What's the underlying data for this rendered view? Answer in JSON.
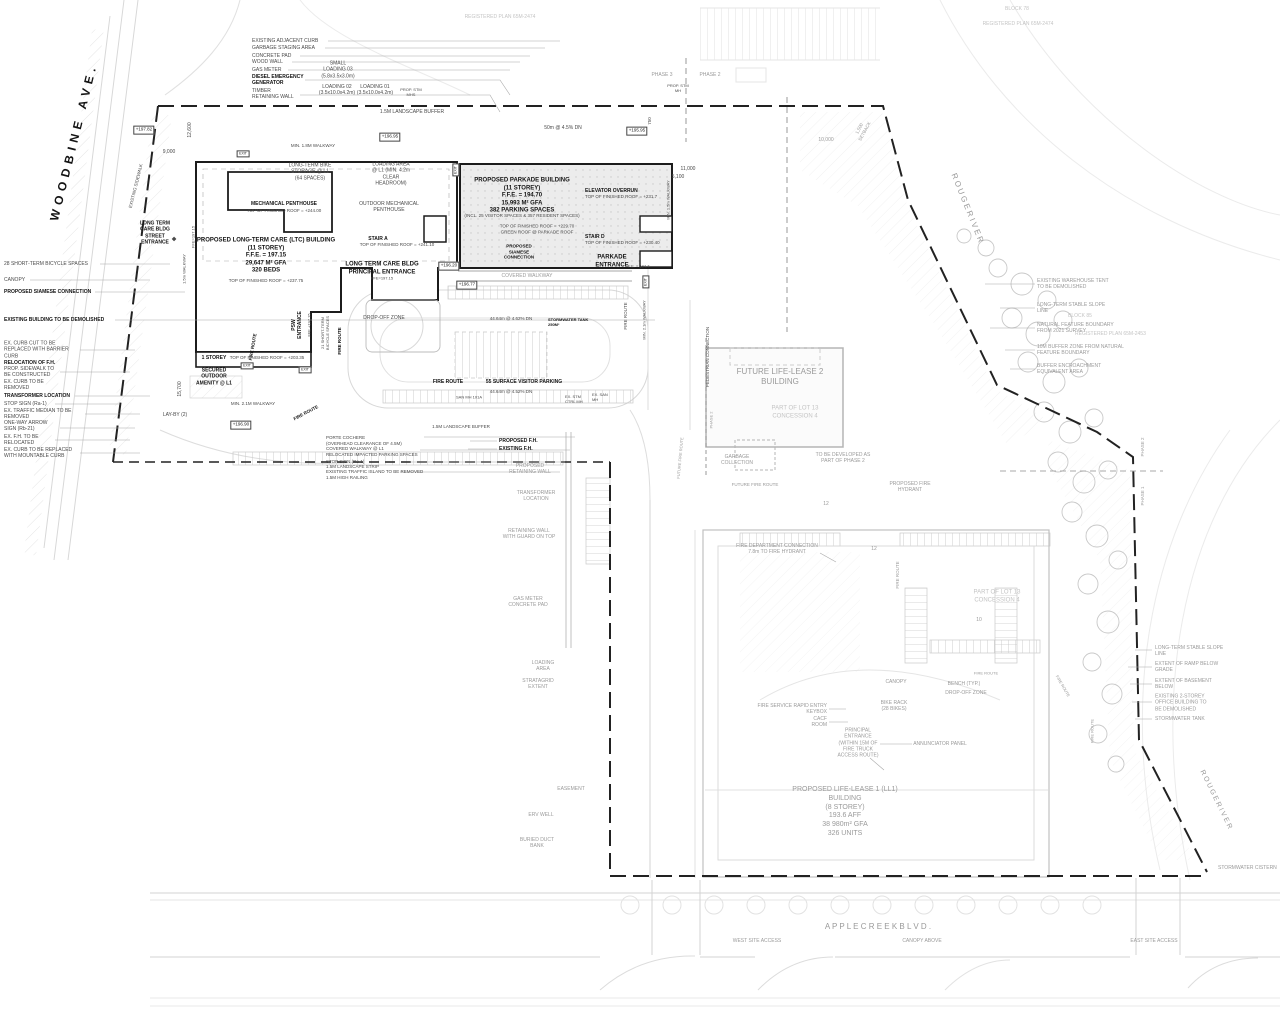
{
  "colors": {
    "building_outline": "#1c1c1c",
    "parkade_fill": "#ececec",
    "boundary": "#222222",
    "faint_line": "#d8d8d8",
    "gray_text": "#9a9a9a"
  },
  "labels": [
    {
      "n": "street-name-woodbine",
      "t": "WOODBINE AVE.",
      "x": 74,
      "y": 142,
      "r": -76,
      "s": 12,
      "ls": 5,
      "c": "b"
    },
    {
      "n": "street-name-apple-creek",
      "t": "A P P L E   C R E E K   B L V D .",
      "x": 878,
      "y": 927,
      "c": "g",
      "s": 8
    },
    {
      "n": "rouge-river-label",
      "t": "R O U G E   R I V E R",
      "x": 967,
      "y": 208,
      "r": 68,
      "c": "g",
      "s": 8
    },
    {
      "n": "rouge-river-label",
      "t": "R O U G E   R I V E R",
      "x": 1215,
      "y": 800,
      "r": 64,
      "c": "g",
      "s": 7
    },
    {
      "t": "WEST SITE ACCESS",
      "x": 757,
      "y": 941,
      "c": "g",
      "s": 5
    },
    {
      "t": "CANOPY ABOVE",
      "x": 922,
      "y": 941,
      "c": "g",
      "s": 5
    },
    {
      "t": "EAST SITE ACCESS",
      "x": 1154,
      "y": 941,
      "c": "g",
      "s": 5
    },
    {
      "t": "REGISTERED PLAN 65M-2474",
      "x": 500,
      "y": 17,
      "c": "f"
    },
    {
      "t": "BLOCK 78",
      "x": 1017,
      "y": 9,
      "c": "f"
    },
    {
      "t": "REGISTERED PLAN 65M-2474",
      "x": 1018,
      "y": 24,
      "c": "f"
    },
    {
      "t": "PHASE 3",
      "x": 662,
      "y": 75,
      "c": "g"
    },
    {
      "t": "PHASE 2",
      "x": 710,
      "y": 75,
      "c": "g"
    },
    {
      "t": "PROP. STM\nMH",
      "x": 678,
      "y": 88,
      "s": 4
    },
    {
      "t": "EXISTING ADJACENT CURB",
      "a": "l",
      "x": 252,
      "y": 41
    },
    {
      "t": "GARBAGE STAGING AREA",
      "a": "l",
      "x": 252,
      "y": 48
    },
    {
      "t": "CONCRETE PAD",
      "a": "l",
      "x": 252,
      "y": 56
    },
    {
      "t": "WOOD WALL",
      "a": "l",
      "x": 252,
      "y": 62
    },
    {
      "t": "GAS METER",
      "a": "l",
      "x": 252,
      "y": 70
    },
    {
      "t": "DIESEL EMERGENCY\nGENERATOR",
      "b": 1,
      "a": "l",
      "x": 252,
      "y": 80
    },
    {
      "t": "TIMBER\nRETAINING WALL",
      "a": "l",
      "x": 252,
      "y": 94
    },
    {
      "t": "SMALL\nLOADING 03\n(5.8x3.5x3.0m)",
      "x": 338,
      "y": 70
    },
    {
      "t": "LOADING 02\n(3.5x10.0x4.2m)",
      "x": 337,
      "y": 90
    },
    {
      "t": "LOADING 01\n(3.5x10.0x4.2m)",
      "x": 375,
      "y": 90
    },
    {
      "t": "PROP. STM\nMHS",
      "x": 411,
      "y": 92,
      "s": 4
    },
    {
      "t": "1.5M LANDSCAPE BUFFER",
      "x": 412,
      "y": 112
    },
    {
      "t": "50m @ 4.5% DN",
      "x": 563,
      "y": 128
    },
    {
      "t": "+195.95",
      "x": 637,
      "y": 131,
      "c": "bx"
    },
    {
      "t": "+196.95",
      "x": 390,
      "y": 137,
      "c": "bx"
    },
    {
      "t": "+197.82",
      "x": 144,
      "y": 130,
      "c": "bx"
    },
    {
      "t": "12,600",
      "x": 190,
      "y": 130,
      "r": -90
    },
    {
      "t": "9,000",
      "x": 169,
      "y": 152
    },
    {
      "t": "MIN. 1.8M WALKWAY",
      "x": 313,
      "y": 146,
      "s": 4.5
    },
    {
      "t": "EXISTING SIDEWALK",
      "x": 136,
      "y": 186,
      "r": -76,
      "s": 4.5
    },
    {
      "t": "15,700",
      "x": 180,
      "y": 389,
      "r": -90
    },
    {
      "t": "LONG TERM\nCARE BLDG\nSTREET\nENTRANCE",
      "b": 1,
      "x": 155,
      "y": 233
    },
    {
      "t": "◆",
      "x": 174,
      "y": 240,
      "s": 6
    },
    {
      "t": "FFE=197.15",
      "x": 193,
      "y": 237,
      "r": -90,
      "s": 4
    },
    {
      "t": "1.5m WALKWAY",
      "x": 184,
      "y": 269,
      "r": -90,
      "s": 4
    },
    {
      "t": "LONG-TERM BIKE\nSTORAGE @ L1\n(64 SPACES)",
      "x": 310,
      "y": 172
    },
    {
      "t": "LOADING AREA\n@ L1 (MIN. 4.2m\nCLEAR\nHEADROOM)",
      "x": 391,
      "y": 174
    },
    {
      "t": "MECHANICAL PENTHOUSE",
      "b": 1,
      "x": 284,
      "y": 204
    },
    {
      "t": "TOP OF FINISHED ROOF = +244.00",
      "x": 284,
      "y": 211,
      "s": 4.5
    },
    {
      "t": "OUTDOOR MECHANICAL\nPENTHOUSE",
      "x": 389,
      "y": 207
    },
    {
      "n": "ltc-building-title",
      "t": "PROPOSED LONG-TERM CARE (LTC) BUILDING\n(11 STOREY)\nF.F.E. = 197.15\n29,647 M² GFA\n320 BEDS",
      "b": 1,
      "x": 266,
      "y": 256,
      "s": 6
    },
    {
      "t": "TOP OF FINISHED ROOF = +237.75",
      "x": 266,
      "y": 281,
      "s": 4.5
    },
    {
      "t": "STAIR A",
      "b": 1,
      "x": 378,
      "y": 239
    },
    {
      "t": "TOP OF FINISHED ROOF = +241.10",
      "x": 397,
      "y": 245,
      "s": 4.5
    },
    {
      "t": "LONG TERM CARE BLDG\nPRINCIPAL ENTRANCE",
      "b": 1,
      "x": 382,
      "y": 269,
      "s": 6
    },
    {
      "t": "FFE=197.15",
      "x": 382,
      "y": 278,
      "s": 4
    },
    {
      "t": "+196.20",
      "x": 449,
      "y": 266,
      "c": "bx"
    },
    {
      "t": "+196.77",
      "x": 467,
      "y": 285,
      "c": "bx"
    },
    {
      "t": "DROP-OFF ZONE",
      "x": 384,
      "y": 318
    },
    {
      "t": "PSW\nENTRANCE",
      "b": 1,
      "x": 297,
      "y": 325,
      "r": -90
    },
    {
      "t": "FFE +197.15",
      "x": 309,
      "y": 325,
      "r": -90,
      "s": 4
    },
    {
      "t": "21 SHORT-TERM\nBICYCLE SPACES",
      "x": 325,
      "y": 333,
      "r": -90,
      "s": 4
    },
    {
      "t": "FIRE ROUTE",
      "b": 1,
      "x": 340,
      "y": 341,
      "r": -90,
      "s": 4.5
    },
    {
      "t": "1 STOREY",
      "b": 1,
      "x": 214,
      "y": 358
    },
    {
      "t": "TOP OF FINISHED ROOF = +203.35",
      "x": 267,
      "y": 358,
      "s": 4.5
    },
    {
      "t": "SECURED\nOUTDOOR\nAMENITY @ L1",
      "b": 1,
      "x": 214,
      "y": 377
    },
    {
      "t": "MIN. 2.1M WALKWAY",
      "x": 253,
      "y": 404,
      "s": 4.5
    },
    {
      "t": "LAY-BY (2)",
      "x": 175,
      "y": 415
    },
    {
      "t": "+196.90",
      "x": 241,
      "y": 425,
      "c": "bx"
    },
    {
      "t": "EXIT",
      "x": 243,
      "y": 154,
      "s": 3.5,
      "c": "bx"
    },
    {
      "t": "EXIT",
      "x": 247,
      "y": 366,
      "s": 3.5,
      "c": "bx"
    },
    {
      "t": "EXIT",
      "x": 305,
      "y": 370,
      "s": 3.5,
      "c": "bx"
    },
    {
      "t": "EXIT",
      "x": 456,
      "y": 170,
      "r": -90,
      "s": 3.5,
      "c": "bx"
    },
    {
      "t": "EXIT",
      "x": 646,
      "y": 282,
      "r": -90,
      "s": 3.5,
      "c": "bx"
    },
    {
      "n": "parkade-building-title",
      "t": "PROPOSED PARKADE BUILDING\n(11 STOREY)\nF.F.E. = 194.70\n15,993 M² GFA\n382 PARKING SPACES",
      "b": 1,
      "x": 522,
      "y": 196,
      "s": 6
    },
    {
      "t": "(INCL. 25 VISITOR SPACES & 357 RESIDENT SPACES)",
      "x": 522,
      "y": 216,
      "s": 4.5
    },
    {
      "t": "TOP OF FINISHED ROOF = +229.70\nGREEN ROOF @ PARKADE ROOF",
      "x": 537,
      "y": 229,
      "s": 4.5
    },
    {
      "t": "ELEVATOR OVERRUN",
      "b": 1,
      "a": "l",
      "x": 585,
      "y": 191
    },
    {
      "t": "TOP OF FINISHED ROOF = +231.7",
      "a": "l",
      "x": 585,
      "y": 197,
      "s": 4.5
    },
    {
      "t": "STAIR D",
      "b": 1,
      "a": "l",
      "x": 585,
      "y": 237
    },
    {
      "t": "TOP OF FINISHED ROOF = +230.40",
      "a": "l",
      "x": 585,
      "y": 243,
      "s": 4.5
    },
    {
      "t": "PROPOSED\nSIAMESE\nCONNECTION",
      "b": 1,
      "x": 519,
      "y": 252,
      "s": 4.5
    },
    {
      "t": "PARKADE\nENTRANCE",
      "b": 1,
      "x": 612,
      "y": 262,
      "s": 6
    },
    {
      "t": "F.E. = 194.7",
      "a": "l",
      "x": 628,
      "y": 266,
      "s": 4
    },
    {
      "t": "COVERED WALKWAY",
      "x": 527,
      "y": 276,
      "c": "g"
    },
    {
      "t": "MIN. 1.5m WALKWAY",
      "x": 668,
      "y": 200,
      "r": -90,
      "s": 4
    },
    {
      "t": "750",
      "x": 650,
      "y": 121,
      "r": -90,
      "s": 4.5
    },
    {
      "t": "11,000",
      "x": 688,
      "y": 169
    },
    {
      "t": "5,100",
      "x": 678,
      "y": 177
    },
    {
      "t": "10,000",
      "x": 826,
      "y": 140,
      "c": "g"
    },
    {
      "t": "1,500\nSETBACK",
      "x": 862,
      "y": 130,
      "r": -62,
      "c": "g",
      "s": 4.5
    },
    {
      "t": "44.64m @ 4.62% DN",
      "x": 511,
      "y": 319,
      "s": 4.5
    },
    {
      "t": "STORMWATER TANK\n250M³",
      "b": 1,
      "a": "l",
      "x": 548,
      "y": 322,
      "s": 4
    },
    {
      "t": "FIRE ROUTE",
      "b": 1,
      "x": 448,
      "y": 382,
      "s": 5
    },
    {
      "t": "55 SURFACE VISITOR PARKING",
      "b": 1,
      "x": 524,
      "y": 382,
      "s": 5
    },
    {
      "t": "44.64m @ 4.52% DN",
      "x": 511,
      "y": 392,
      "s": 4.5
    },
    {
      "t": "SAN MH 101A",
      "x": 469,
      "y": 397,
      "s": 4
    },
    {
      "t": "EX. STM\nCTRL MH",
      "a": "l",
      "x": 565,
      "y": 399,
      "s": 4
    },
    {
      "t": "EX. SAN\nMH",
      "a": "l",
      "x": 592,
      "y": 397,
      "s": 4
    },
    {
      "t": "FIRE ROUTE",
      "x": 626,
      "y": 316,
      "r": -90,
      "s": 4.5
    },
    {
      "t": "MIN. 2.1m WALKWAY",
      "x": 644,
      "y": 320,
      "r": -90,
      "s": 4
    },
    {
      "t": "PEDESTRIAN CONNECTION",
      "x": 708,
      "y": 357,
      "r": -90,
      "s": 4.5
    },
    {
      "t": "PHASE 2",
      "x": 711,
      "y": 420,
      "r": -90,
      "c": "g",
      "s": 4
    },
    {
      "t": "FIRE ROUTE",
      "b": 1,
      "x": 253,
      "y": 347,
      "r": -80,
      "s": 4.5
    },
    {
      "t": "FIRE ROUTE",
      "b": 1,
      "x": 306,
      "y": 413,
      "r": -28,
      "s": 4.5
    },
    {
      "t": "PORTE COCHERE\n(OVERHEAD CLEARANCE OF 4.5M)\nCOVERED WALKWAY @ L1\nRELOCATED IMPACTED PARKING SPACES",
      "a": "l",
      "x": 326,
      "y": 446,
      "s": 4.5
    },
    {
      "t": "STOP SIGN (Ra-1)",
      "a": "l",
      "x": 326,
      "y": 462,
      "s": 4.5
    },
    {
      "t": "1.5M LANDSCAPE STRIP",
      "a": "l",
      "x": 326,
      "y": 467,
      "s": 4.5
    },
    {
      "t": "EXISTING TRAFFIC ISLAND TO BE REMOVED",
      "a": "l",
      "x": 326,
      "y": 472,
      "s": 4.5
    },
    {
      "t": "1.5M HIGH RAILING",
      "a": "l",
      "x": 326,
      "y": 478,
      "s": 4.5
    },
    {
      "t": "1.5M LANDSCAPE BUFFER",
      "x": 461,
      "y": 427,
      "s": 4.5
    },
    {
      "t": "PROPOSED F.H.",
      "b": 1,
      "a": "l",
      "x": 499,
      "y": 441
    },
    {
      "t": "EXISTING F.H.",
      "b": 1,
      "a": "l",
      "x": 499,
      "y": 449
    },
    {
      "t": "PROPOSED\nRETAINING WALL",
      "x": 530,
      "y": 469,
      "c": "g"
    },
    {
      "t": "TRANSFORMER\nLOCATION",
      "x": 536,
      "y": 496,
      "c": "g"
    },
    {
      "t": "RETAINING WALL\nWITH GUARD ON TOP",
      "x": 529,
      "y": 534,
      "c": "g"
    },
    {
      "t": "GAS METER\nCONCRETE PAD",
      "x": 528,
      "y": 602,
      "c": "g"
    },
    {
      "t": "28 SHORT-TERM BICYCLE SPACES",
      "a": "l",
      "x": 4,
      "y": 264
    },
    {
      "t": "CANOPY",
      "a": "l",
      "x": 4,
      "y": 280
    },
    {
      "t": "PROPOSED SIAMESE CONNECTION",
      "b": 1,
      "a": "l",
      "x": 4,
      "y": 292
    },
    {
      "t": "EXISTING BUILDING TO BE DEMOLISHED",
      "b": 1,
      "a": "l",
      "x": 4,
      "y": 320
    },
    {
      "t": "EX. CURB CUT TO BE\nREPLACED WITH BARRIER\nCURB",
      "a": "l",
      "x": 4,
      "y": 350
    },
    {
      "t": "RELOCATION OF F.H.",
      "b": 1,
      "a": "l",
      "x": 4,
      "y": 363
    },
    {
      "t": "PROP. SIDEWALK TO\nBE CONSTRUCTED",
      "a": "l",
      "x": 4,
      "y": 372
    },
    {
      "t": "EX. CURB TO BE\nREMOVED",
      "a": "l",
      "x": 4,
      "y": 385
    },
    {
      "t": "TRANSFORMER LOCATION",
      "b": 1,
      "a": "l",
      "x": 4,
      "y": 396
    },
    {
      "t": "STOP SIGN (Ra-1)",
      "a": "l",
      "x": 4,
      "y": 404
    },
    {
      "t": "EX. TRAFFIC MEDIAN TO BE\nREMOVED",
      "a": "l",
      "x": 4,
      "y": 414
    },
    {
      "t": "ONE-WAY ARROW\nSIGN (Rb-21)",
      "a": "l",
      "x": 4,
      "y": 426
    },
    {
      "t": "EX. F.H. TO BE\nRELOCATED",
      "a": "l",
      "x": 4,
      "y": 440
    },
    {
      "t": "EX. CURB TO BE REPLACED\nWITH MOUNTABLE CURB",
      "a": "l",
      "x": 4,
      "y": 453
    },
    {
      "n": "ll2-building-title",
      "t": "FUTURE LIFE-LEASE 2\nBUILDING",
      "x": 780,
      "y": 377,
      "c": "g",
      "s": 8
    },
    {
      "t": "PART OF LOT 13\nCONCESSION 4",
      "x": 795,
      "y": 413,
      "c": "f",
      "s": 6
    },
    {
      "t": "GARBAGE\nCOLLECTION",
      "x": 737,
      "y": 460,
      "c": "g"
    },
    {
      "t": "TO BE DEVELOPED AS\nPART OF PHASE 2",
      "x": 843,
      "y": 458,
      "c": "g"
    },
    {
      "t": "FUTURE FIRE ROUTE",
      "x": 755,
      "y": 485,
      "c": "g",
      "s": 4.5
    },
    {
      "t": "FUTURE FIRE ROUTE",
      "x": 680,
      "y": 458,
      "r": -85,
      "c": "g",
      "s": 4
    },
    {
      "t": "PROPOSED FIRE\nHYDRANT",
      "x": 910,
      "y": 487,
      "c": "g"
    },
    {
      "t": "12",
      "x": 826,
      "y": 504,
      "c": "g"
    },
    {
      "t": "EXISTING WAREHOUSE TENT\nTO BE DEMOLISHED",
      "a": "l",
      "x": 1037,
      "y": 284,
      "c": "g"
    },
    {
      "t": "LONG-TERM STABLE SLOPE\nLINE",
      "a": "l",
      "x": 1037,
      "y": 308,
      "c": "g"
    },
    {
      "t": "BLOCK 85",
      "a": "l",
      "x": 1068,
      "y": 316,
      "c": "f"
    },
    {
      "t": "NATURAL FEATURE BOUNDARY\nFROM 2021 SURVEY",
      "a": "l",
      "x": 1037,
      "y": 328,
      "c": "g"
    },
    {
      "t": "REGISTERED PLAN 65M-2453",
      "a": "l",
      "x": 1075,
      "y": 334,
      "c": "f"
    },
    {
      "t": "10M BUFFER ZONE FROM NATURAL\nFEATURE BOUNDARY",
      "a": "l",
      "x": 1037,
      "y": 350,
      "c": "g"
    },
    {
      "t": "BUFFER ENCROACHMENT\nEQUIVALENT AREA",
      "a": "l",
      "x": 1037,
      "y": 369,
      "c": "g"
    },
    {
      "t": "PHASE 2",
      "x": 1143,
      "y": 447,
      "r": -90,
      "c": "g",
      "s": 4.5
    },
    {
      "t": "PHASE 1",
      "x": 1143,
      "y": 496,
      "r": -90,
      "c": "g",
      "s": 4.5
    },
    {
      "t": "LOADING\nAREA",
      "x": 543,
      "y": 666,
      "c": "g"
    },
    {
      "t": "STRATAGRID\nEXTENT",
      "x": 538,
      "y": 684,
      "c": "g"
    },
    {
      "t": "EASEMENT",
      "x": 571,
      "y": 789,
      "c": "g"
    },
    {
      "t": "ERV WELL",
      "x": 541,
      "y": 815,
      "c": "g"
    },
    {
      "t": "BURIED DUCT\nBANK",
      "x": 537,
      "y": 843,
      "c": "g"
    },
    {
      "t": "FIRE DEPARTMENT CONNECTION\n7.8m TO FIRE HYDRANT",
      "x": 777,
      "y": 549,
      "c": "g"
    },
    {
      "t": "FIRE ROUTE",
      "x": 898,
      "y": 575,
      "r": -90,
      "c": "g",
      "s": 4.5
    },
    {
      "t": "PART OF LOT 13\nCONCESSION 4",
      "x": 997,
      "y": 597,
      "c": "f",
      "s": 6
    },
    {
      "t": "12",
      "x": 874,
      "y": 549,
      "c": "g"
    },
    {
      "t": "10",
      "x": 979,
      "y": 620,
      "c": "g"
    },
    {
      "t": "FIRE ROUTE",
      "x": 986,
      "y": 673,
      "c": "g",
      "s": 4
    },
    {
      "t": "CANOPY",
      "x": 896,
      "y": 682,
      "c": "g"
    },
    {
      "t": "BENCH (TYP.)",
      "x": 964,
      "y": 684,
      "c": "g"
    },
    {
      "t": "DROP-OFF ZONE",
      "x": 966,
      "y": 693,
      "c": "g"
    },
    {
      "t": "BIKE RACK\n(28 BIKES)",
      "x": 894,
      "y": 706,
      "c": "g"
    },
    {
      "t": "FIRE SERVICE RAPID ENTRY\nKEYBOX",
      "a": "r",
      "x": 827,
      "y": 709,
      "c": "g"
    },
    {
      "t": "CACF\nROOM",
      "a": "r",
      "x": 827,
      "y": 722,
      "c": "g"
    },
    {
      "t": "PRINCIPAL\nENTRANCE\n(WITHIN 15M OF\nFIRE TRUCK\nACCESS ROUTE)",
      "x": 858,
      "y": 743,
      "c": "g"
    },
    {
      "t": "ANNUNCIATOR PANEL",
      "x": 940,
      "y": 744,
      "c": "g"
    },
    {
      "n": "ll1-building-title",
      "t": "PROPOSED LIFE-LEASE 1 (LL1)\nBUILDING\n(8 STOREY)\n193.6 AFF\n38 980m² GFA\n326 UNITS",
      "x": 845,
      "y": 812,
      "c": "g",
      "s": 7
    },
    {
      "t": "FIRE ROUTE",
      "x": 1092,
      "y": 731,
      "r": -90,
      "c": "g",
      "s": 4
    },
    {
      "t": "FIRE ROUTE",
      "x": 1063,
      "y": 686,
      "r": 60,
      "c": "g",
      "s": 4
    },
    {
      "t": "LONG-TERM STABLE SLOPE\nLINE",
      "a": "l",
      "x": 1155,
      "y": 651,
      "c": "g"
    },
    {
      "t": "EXTENT OF RAMP BELOW\nGRADE",
      "a": "l",
      "x": 1155,
      "y": 667,
      "c": "g"
    },
    {
      "t": "EXTENT OF BASEMENT\nBELOW",
      "a": "l",
      "x": 1155,
      "y": 684,
      "c": "g"
    },
    {
      "t": "EXISTING 2-STOREY\nOFFICE BUILDING TO\nBE DEMOLISHED",
      "a": "l",
      "x": 1155,
      "y": 703,
      "c": "g"
    },
    {
      "t": "STORMWATER TANK",
      "a": "l",
      "x": 1155,
      "y": 719,
      "c": "g"
    },
    {
      "t": "STORMWATER CISTERN",
      "a": "l",
      "x": 1218,
      "y": 868,
      "c": "g"
    }
  ]
}
